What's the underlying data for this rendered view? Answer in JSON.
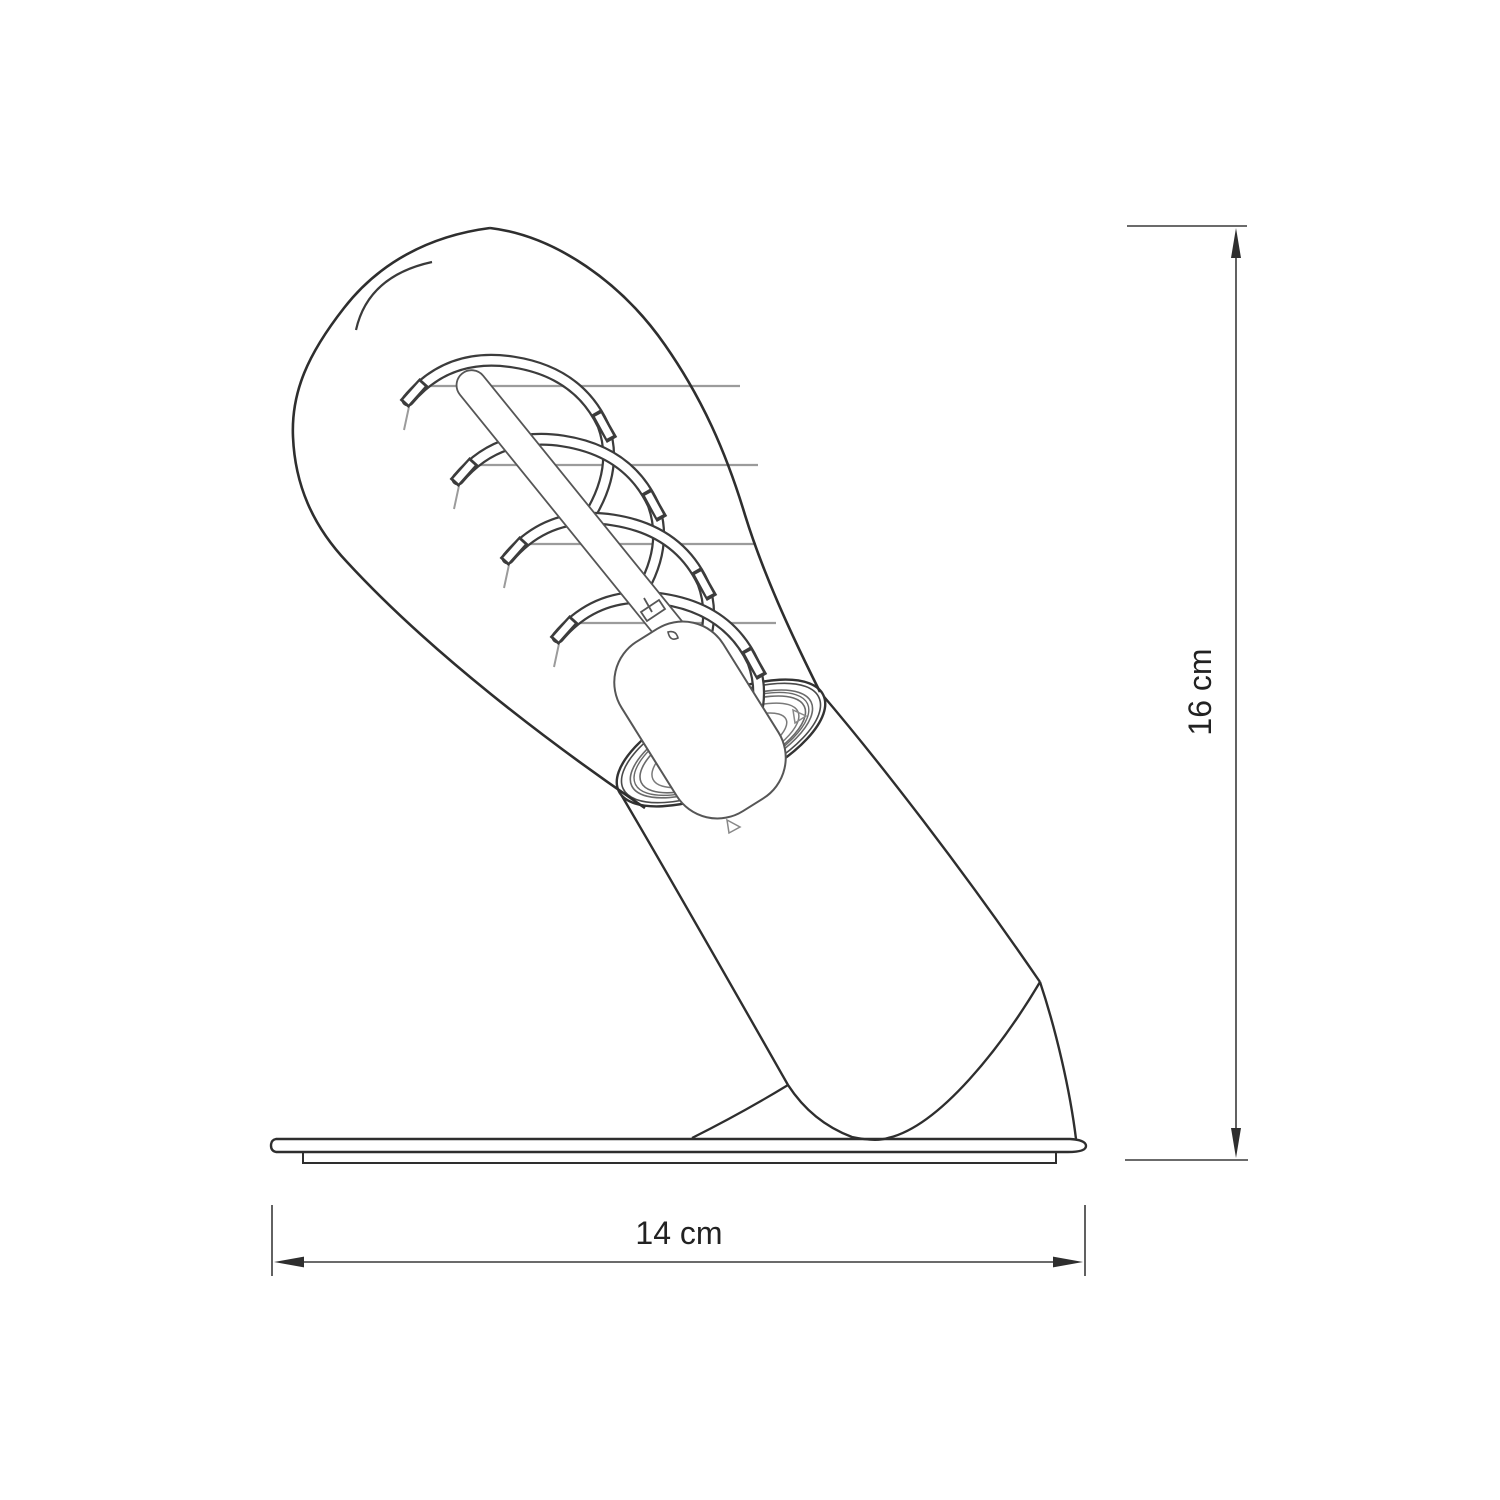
{
  "diagram": {
    "background": "#ffffff",
    "subject": "lamp-dimension-drawing",
    "dimensions": {
      "height_label": "16 cm",
      "width_label": "14 cm"
    },
    "colors": {
      "outline": "#2e2e2e",
      "detail": "#565656",
      "light_detail": "#9b9b9b",
      "dimension_line": "#3a3a3a",
      "label_text": "#222222"
    }
  }
}
